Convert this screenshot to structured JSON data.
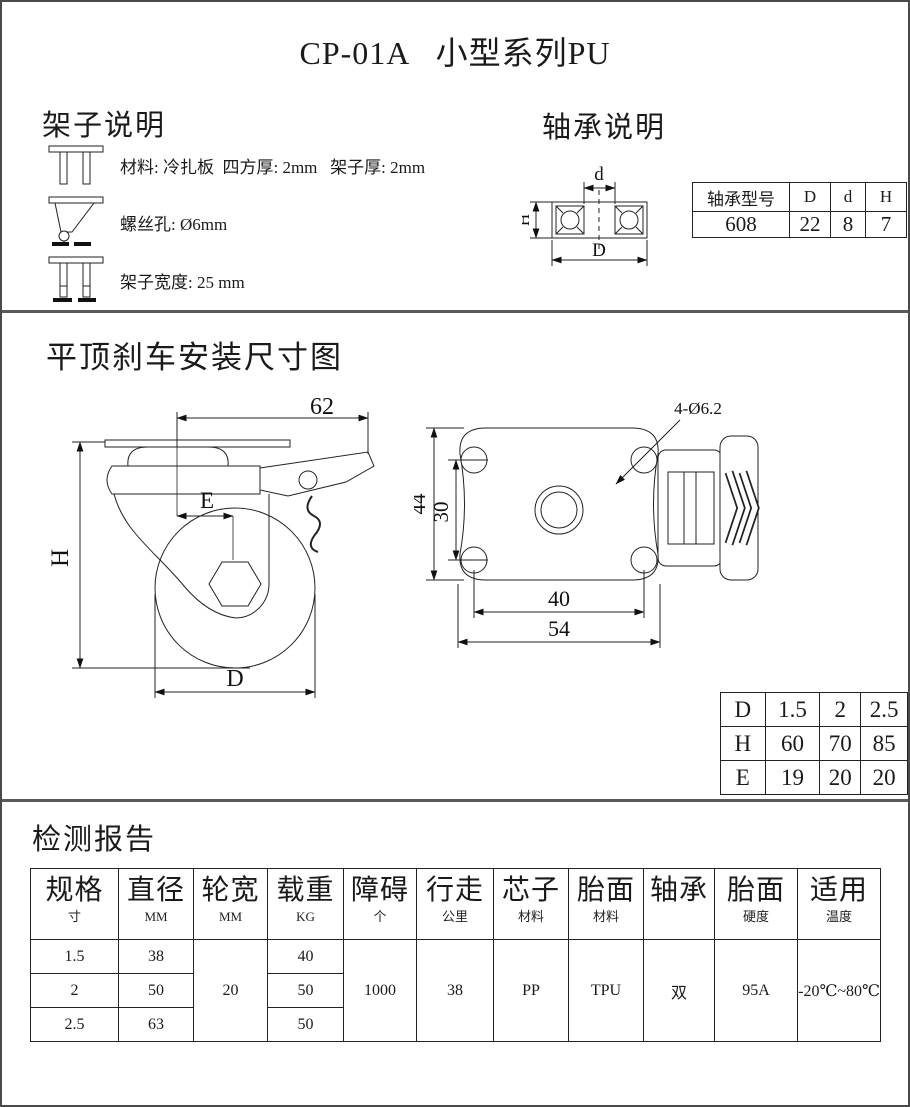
{
  "page": {
    "title": "CP-01A   小型系列PU"
  },
  "frame_section": {
    "heading": "架子说明",
    "items": [
      {
        "icon": "frame-bracket-icon",
        "text": "材料: 冷扎板  四方厚: 2mm   架子厚: 2mm"
      },
      {
        "icon": "frame-fork-screw-icon",
        "text": "螺丝孔: Ø6mm"
      },
      {
        "icon": "frame-width-icon",
        "text": "架子宽度: 25 mm"
      }
    ]
  },
  "bearing_section": {
    "heading": "轴承说明",
    "diagram_labels": {
      "inner": "d",
      "outer": "D",
      "height": "H"
    },
    "table": {
      "headers": [
        "轴承型号",
        "D",
        "d",
        "H"
      ],
      "row": [
        "608",
        "22",
        "8",
        "7"
      ]
    }
  },
  "drawing_section": {
    "heading": "平顶刹车安装尺寸图",
    "side_view": {
      "width_top": "62",
      "swivel_offset": "E",
      "height": "H",
      "wheel_diameter": "D"
    },
    "top_view": {
      "plate_height": "44",
      "hole_spacing_v": "30",
      "hole_spacing_h": "40",
      "plate_width": "54",
      "holes_note": "4-Ø6.2"
    },
    "dhe_table": {
      "rows": [
        [
          "D",
          "1.5",
          "2",
          "2.5"
        ],
        [
          "H",
          "60",
          "70",
          "85"
        ],
        [
          "E",
          "19",
          "20",
          "20"
        ]
      ]
    }
  },
  "report_section": {
    "heading": "检测报告",
    "table": {
      "headers": [
        {
          "main": "规格",
          "sub": "寸"
        },
        {
          "main": "直径",
          "sub": "MM"
        },
        {
          "main": "轮宽",
          "sub": "MM"
        },
        {
          "main": "载重",
          "sub": "KG"
        },
        {
          "main": "障碍",
          "sub": "个"
        },
        {
          "main": "行走",
          "sub": "公里"
        },
        {
          "main": "芯子",
          "sub": "材料"
        },
        {
          "main": "胎面",
          "sub": "材料"
        },
        {
          "main": "轴承",
          "sub": ""
        },
        {
          "main": "胎面",
          "sub": "硬度"
        },
        {
          "main": "适用",
          "sub": "温度"
        }
      ],
      "spec_rows": [
        {
          "size": "1.5",
          "diameter": "38",
          "load": "40"
        },
        {
          "size": "2",
          "diameter": "50",
          "load": "50"
        },
        {
          "size": "2.5",
          "diameter": "63",
          "load": "50"
        }
      ],
      "merged": {
        "wheel_width": "20",
        "obstacle": "1000",
        "distance": "38",
        "core_material": "PP",
        "tread_material": "TPU",
        "bearing": "双",
        "hardness": "95A",
        "temperature": "-20℃~80℃"
      }
    }
  }
}
